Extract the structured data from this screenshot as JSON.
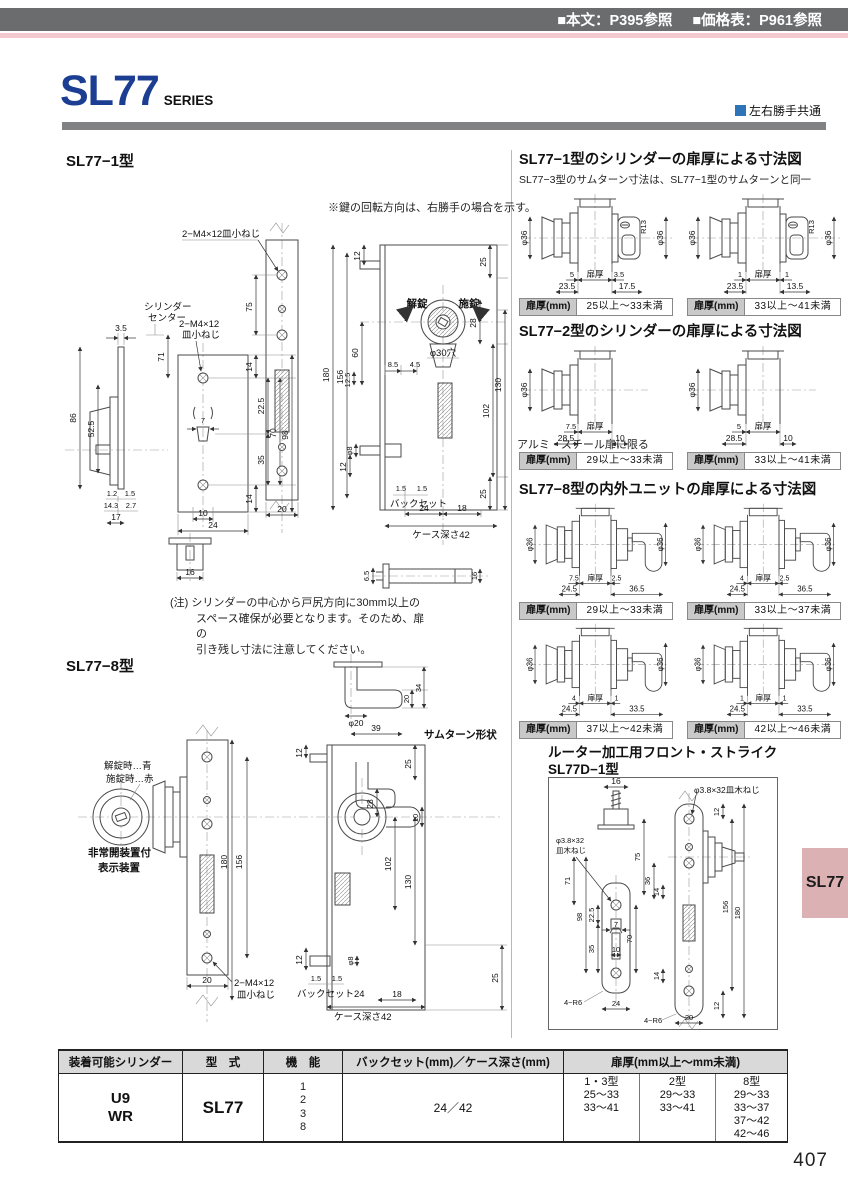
{
  "header": {
    "text_ref": "■本文：P395参照",
    "price_ref": "■価格表：P961参照"
  },
  "brand": {
    "series": "SL77",
    "series_label": "SERIES",
    "handing": "左右勝手共通"
  },
  "colors": {
    "accent_blue": "#1b3e92",
    "bar_gray": "#6b6c6e",
    "pink": "#f4c9cf",
    "tab_pink": "#dcb1b3"
  },
  "left": {
    "sec1": {
      "heading": "SL77−1型",
      "rotation_note": "※鍵の回転方向は、右勝手の場合を示す。",
      "screw_top": "2−M4×12皿小ねじ",
      "cyl_center_1": "シリンダー",
      "cyl_center_2": "センター",
      "screw2_1": "2−M4×12",
      "screw2_2": "皿小ねじ",
      "unlock": "解錠",
      "lock": "施錠",
      "hole": "φ30穴",
      "backset": "バックセット",
      "case_depth": "ケース深さ42",
      "note_1": "(注) シリンダーの中心から戸尻方向に30mm以上の",
      "note_2": "スペース確保が必要となります。そのため、扉の",
      "note_3": "引き残し寸法に注意してください。",
      "dims": {
        "a3_5": "3.5",
        "a86": "86",
        "a52_5": "52.5",
        "a1_2": "1.2",
        "a1_5": "1.5",
        "a14_3": "14.3",
        "a2_7": "2.7",
        "a17": "17",
        "b71": "71",
        "b14t": "14",
        "b22_5": "22.5",
        "b7": "7",
        "b35": "35",
        "b70": "70",
        "b98": "98",
        "b14b": "14",
        "b10": "10",
        "b24": "24",
        "c75": "75",
        "c20": "20",
        "d12t": "12",
        "d25t": "25",
        "d28": "28",
        "d60": "60",
        "d8_5": "8.5",
        "d4_5": "4.5",
        "d12_5": "12.5",
        "d180": "180",
        "d156": "156",
        "d102": "102",
        "d130": "130",
        "d12b": "12",
        "dphi8": "φ8",
        "d25b": "25",
        "d1_5a": "1.5",
        "d1_5b": "1.5",
        "d24": "24",
        "d18": "18",
        "e16": "16",
        "f6_5": "6.5",
        "f16": "16"
      }
    },
    "sec8": {
      "heading": "SL77−8型",
      "thumbturn_label": "サムターン形状",
      "indicator_1": "解錠時…青",
      "indicator_2": "施錠時…赤",
      "device_1": "非常開装置付",
      "device_2": "表示装置",
      "screw_1": "2−M4×12",
      "screw_2": "皿小ねじ",
      "backset": "バックセット24",
      "case_depth": "ケース深さ42",
      "dims": {
        "t20": "20",
        "t34": "34",
        "tphi20": "φ20",
        "t39": "39",
        "d12t": "12",
        "d25t": "25",
        "d28": "28",
        "d10": "10",
        "d180": "180",
        "d156": "156",
        "d130": "130",
        "d102": "102",
        "d12b": "12",
        "dphi8": "φ8",
        "d25b": "25",
        "d1_5a": "1.5",
        "d1_5b": "1.5",
        "d18": "18",
        "p20": "20"
      }
    }
  },
  "right": {
    "sec1": {
      "heading": "SL77−1型のシリンダーの扉厚による寸法図",
      "subtitle": "SL77−3型のサムターン寸法は、SL77−1型のサムターンと同一",
      "badge_label": "扉厚(mm)",
      "diagrams": [
        {
          "phi_left": "φ36",
          "phi_right": "φ36",
          "r": "R13",
          "off_left": "5",
          "door": "扉厚",
          "off_right": "3.5",
          "base_left": "23.5",
          "base_right": "17.5",
          "badge": "25以上〜33未満"
        },
        {
          "phi_left": "φ36",
          "phi_right": "φ36",
          "r": "R13",
          "off_left": "1",
          "door": "扉厚",
          "off_right": "1",
          "base_left": "23.5",
          "base_right": "13.5",
          "badge": "33以上〜41未満"
        }
      ]
    },
    "sec2": {
      "heading": "SL77−2型のシリンダーの扉厚による寸法図",
      "note": "アルミ・スチール扉に限る",
      "badge_label": "扉厚(mm)",
      "diagrams": [
        {
          "phi_left": "φ36",
          "off_left": "7.5",
          "door": "扉厚",
          "base_left": "28.5",
          "base_right": "10",
          "badge": "29以上〜33未満"
        },
        {
          "phi_left": "φ36",
          "off_left": "5",
          "door": "扉厚",
          "base_left": "28.5",
          "base_right": "10",
          "badge": "33以上〜41未満"
        }
      ]
    },
    "sec8": {
      "heading": "SL77−8型の内外ユニットの扉厚による寸法図",
      "badge_label": "扉厚(mm)",
      "diagrams": [
        {
          "phi_left": "φ36",
          "phi_right": "φ36",
          "off_left": "7.5",
          "door": "扉厚",
          "off_right": "2.5",
          "base_left": "24.5",
          "base_right": "36.5",
          "badge": "29以上〜33未満"
        },
        {
          "phi_left": "φ36",
          "phi_right": "φ36",
          "off_left": "4",
          "door": "扉厚",
          "off_right": "2.5",
          "base_left": "24.5",
          "base_right": "36.5",
          "badge": "33以上〜37未満"
        },
        {
          "phi_left": "φ36",
          "phi_right": "φ36",
          "off_left": "4",
          "door": "扉厚",
          "off_right": "1",
          "base_left": "24.5",
          "base_right": "33.5",
          "badge": "37以上〜42未満"
        },
        {
          "phi_left": "φ36",
          "phi_right": "φ36",
          "off_left": "1",
          "door": "扉厚",
          "off_right": "1",
          "base_left": "24.5",
          "base_right": "33.5",
          "badge": "42以上〜46未満"
        }
      ]
    },
    "router": {
      "heading_1": "ルーター加工用フロント・ストライク",
      "heading_2": "SL77D−1型",
      "screw_top": "φ3.8×32皿木ねじ",
      "screw_left_1": "φ3.8×32",
      "screw_left_2": "皿木ねじ",
      "corner_left": "4−R6",
      "corner_right": "4−R6",
      "dims": {
        "s16": "16",
        "d75": "75",
        "d36": "36",
        "d14a": "14",
        "d71": "71",
        "d22_5": "22.5",
        "d7": "7",
        "d35": "35",
        "d70": "70",
        "d10": "10",
        "d98": "98",
        "d156": "156",
        "d180": "180",
        "d12a": "12",
        "d12b": "12",
        "d14b": "14",
        "d24": "24",
        "d20": "20"
      }
    }
  },
  "sidetab": {
    "label": "SL77"
  },
  "table": {
    "headers": [
      "装着可能シリンダー",
      "型　式",
      "機　能",
      "バックセット(mm)／ケース深さ(mm)",
      "扉厚(mm以上〜mm未満)"
    ],
    "row": {
      "cyl_1": "U9",
      "cyl_2": "WR",
      "model": "SL77",
      "functions": [
        "1",
        "2",
        "3",
        "8"
      ],
      "backset": "24／42",
      "groups": [
        {
          "type": "1・3型",
          "values": [
            "25〜33",
            "33〜41"
          ]
        },
        {
          "type": "2型",
          "values": [
            "29〜33",
            "33〜41"
          ]
        },
        {
          "type": "8型",
          "values": [
            "29〜33",
            "33〜37",
            "37〜42",
            "42〜46"
          ]
        }
      ]
    }
  },
  "page_number": "407"
}
